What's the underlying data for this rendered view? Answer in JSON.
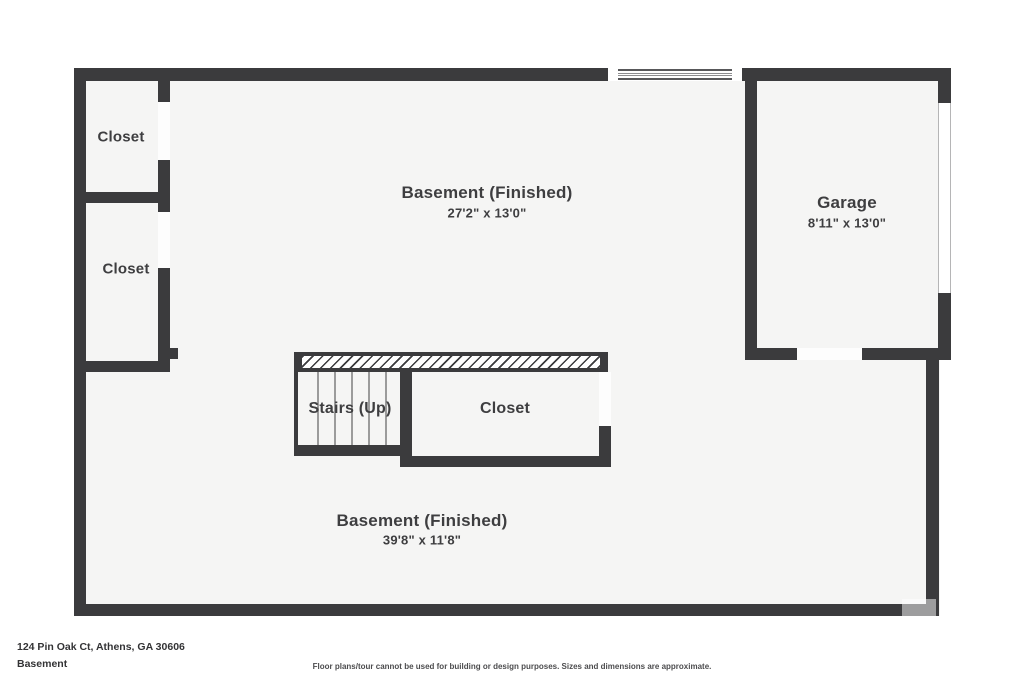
{
  "plan": {
    "colors": {
      "wall": "#3b3b3d",
      "floor": "#f5f5f4",
      "label_text": "#3e3e40"
    },
    "labels": {
      "basement_upper": {
        "name": "Basement (Finished)",
        "dims": "27'2\" x 13'0\""
      },
      "basement_lower": {
        "name": "Basement (Finished)",
        "dims": "39'8\" x 11'8\""
      },
      "garage": {
        "name": "Garage",
        "dims": "8'11\" x 13'0\""
      },
      "closet_top": {
        "name": "Closet"
      },
      "closet_left": {
        "name": "Closet"
      },
      "closet_center": {
        "name": "Closet"
      },
      "stairs": {
        "name": "Stairs (Up)"
      }
    }
  },
  "footer": {
    "address": "124 Pin Oak Ct, Athens, GA 30606",
    "floor_name": "Basement",
    "disclaimer": "Floor plans/tour cannot be used for building or design purposes. Sizes and dimensions are approximate."
  }
}
